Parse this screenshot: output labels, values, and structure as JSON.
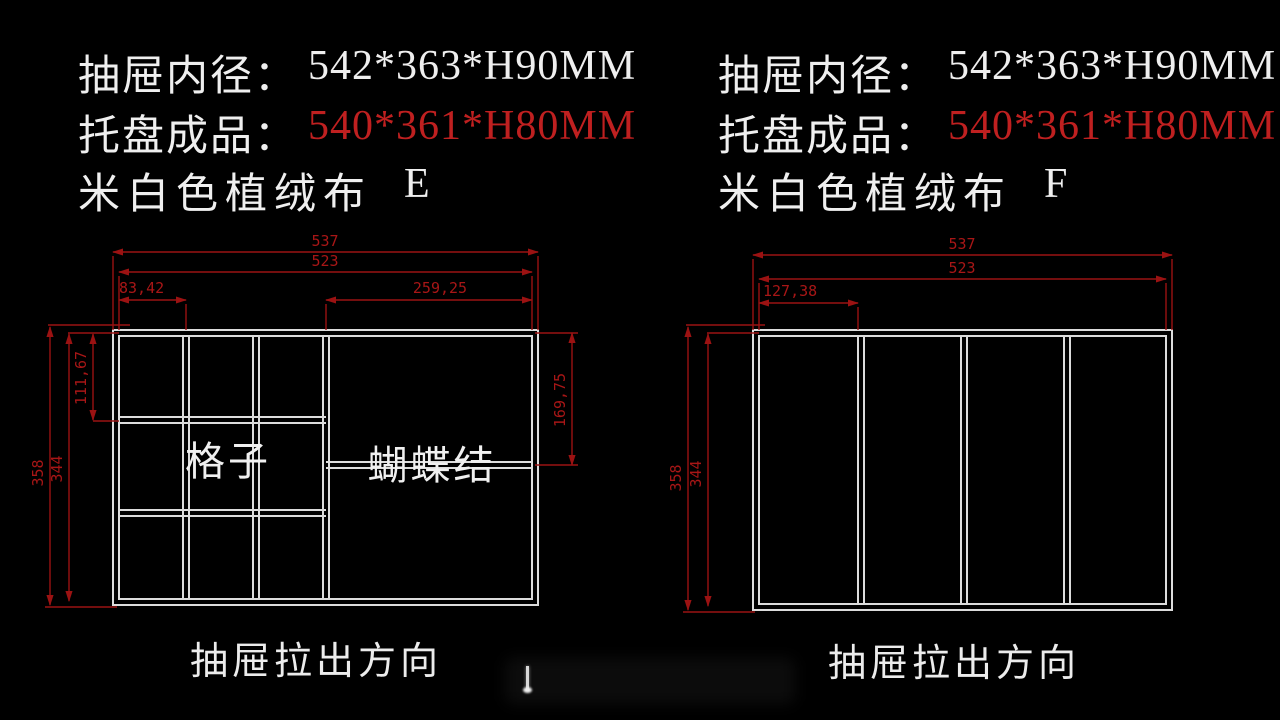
{
  "colors": {
    "background": "#000000",
    "drawing_line": "#dcdcdc",
    "dimension_red": "#9b1212",
    "accent_red": "#bf2020",
    "text_white": "#efefef"
  },
  "panels": [
    {
      "code": "E",
      "header": {
        "line1_label": "抽屉内径：",
        "line1_value": "542*363*H90MM",
        "line2_label": "托盘成品：",
        "line2_value": "540*361*H80MM",
        "line3_label": "米白色植绒布",
        "line3_value": "E"
      },
      "drawing": {
        "dims": {
          "overall_width": "537",
          "inner_width": "523",
          "first_cell_width": "83,42",
          "bow_section_width": "259,25",
          "overall_height": "358",
          "inner_height": "344",
          "first_cell_height": "111,67",
          "bow_divider_height": "169,75"
        },
        "cells": {
          "grid_label": "格子",
          "bow_label": "蝴蝶结"
        }
      },
      "footer": {
        "direction_label": "抽屉拉出方向"
      }
    },
    {
      "code": "F",
      "header": {
        "line1_label": "抽屉内径：",
        "line1_value": "542*363*H90MM",
        "line2_label": "托盘成品：",
        "line2_value": "540*361*H80MM",
        "line3_label": "米白色植绒布",
        "line3_value": "F"
      },
      "drawing": {
        "dims": {
          "overall_width": "537",
          "inner_width": "523",
          "first_cell_width": "127,38",
          "overall_height": "358",
          "inner_height": "344"
        }
      },
      "footer": {
        "direction_label": "抽屉拉出方向"
      }
    }
  ]
}
